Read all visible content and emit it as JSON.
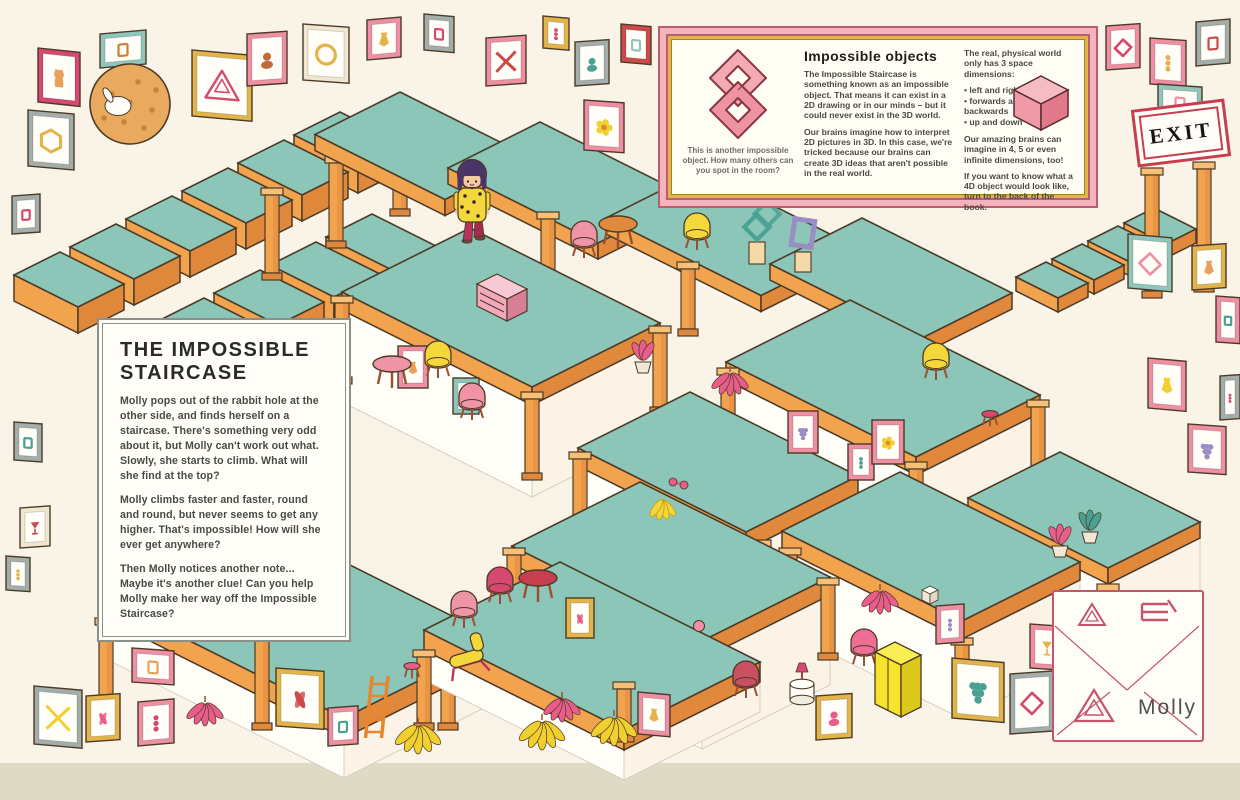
{
  "story_box": {
    "title": "THE IMPOSSIBLE STAIRCASE",
    "paragraphs": [
      "Molly pops out of the rabbit hole at the other side, and finds herself on a staircase. There's something very odd about it, but Molly can't work out what. Slowly, she starts to climb. What will she find at the top?",
      "Molly climbs faster and faster, round and round, but never seems to get any higher. That's impossible! How will she ever get anywhere?",
      "Then Molly notices another note... Maybe it's another clue! Can you help Molly make her way off the Impossible Staircase?"
    ]
  },
  "info_box": {
    "heading": "Impossible objects",
    "caption": "This is another impossible object. How many others can you spot in the room?",
    "col1_paragraphs": [
      "The Impossible Staircase is something known as an impossible object. That means it can exist in a 2D drawing or in our minds – but it could never exist in the 3D world.",
      "Our brains imagine how to interpret 2D pictures in 3D. In this case, we're tricked because our brains can create 3D ideas that aren't possible in the real world."
    ],
    "col2_intro": "The real, physical world only has 3 space dimensions:",
    "col2_bullets": [
      "left and right",
      "forwards and backwards",
      "up and down"
    ],
    "col2_paragraphs": [
      "Our amazing brains can imagine in 4, 5 or even infinite dimensions, too!",
      "If you want to know what a 4D object would look like, turn to the back of the book."
    ]
  },
  "exit_sign": {
    "label": "EXIT"
  },
  "envelope": {
    "label": "Molly"
  },
  "colors": {
    "line": "#4c3a26",
    "teal": "#8bc6b8",
    "orange": "#f2a34e",
    "orangeL": "#f7c078",
    "orangeD": "#e0893c",
    "wall": "#fffef8",
    "wall2": "#faf3e6",
    "wallEdge": "#d8cdbb",
    "bg": "#f9f3e8",
    "strip": "#dedac6",
    "accent_pink": "#ee8fa4",
    "accent_red": "#c73f4f"
  },
  "scene": {
    "structure": [
      {
        "op": "steps",
        "t": [
          60,
          252
        ],
        "n": 6,
        "dx": 56,
        "dy": -28,
        "a": 64,
        "b": 46,
        "h": 26
      },
      {
        "op": "steps",
        "t": [
          148,
          326
        ],
        "n": 5,
        "dx": 56,
        "dy": -28,
        "a": 64,
        "b": 46,
        "h": 26
      },
      {
        "op": "col",
        "p": [
          272,
          188,
          92
        ]
      },
      {
        "op": "col",
        "p": [
          336,
          156,
          92
        ]
      },
      {
        "op": "col",
        "p": [
          400,
          124,
          92
        ]
      },
      {
        "op": "plat",
        "t": [
          400,
          92
        ],
        "a": 130,
        "b": 85,
        "h": 16
      },
      {
        "op": "plat",
        "t": [
          540,
          122
        ],
        "a": 150,
        "b": 92,
        "h": 16
      },
      {
        "op": "plat",
        "t": [
          702,
          170
        ],
        "a": 155,
        "b": 96,
        "h": 16
      },
      {
        "op": "plat",
        "t": [
          862,
          218
        ],
        "a": 150,
        "b": 92,
        "h": 16
      },
      {
        "op": "col",
        "p": [
          548,
          212,
          74
        ]
      },
      {
        "op": "col",
        "p": [
          688,
          262,
          74
        ]
      },
      {
        "op": "col",
        "p": [
          858,
          312,
          74
        ]
      },
      {
        "op": "steps",
        "t": [
          1046,
          262
        ],
        "n": 4,
        "dx": 36,
        "dy": -18,
        "a": 42,
        "b": 30,
        "h": 14
      },
      {
        "op": "col",
        "p": [
          1152,
          168,
          130
        ]
      },
      {
        "op": "col",
        "p": [
          1204,
          162,
          130
        ]
      },
      {
        "op": "plat",
        "t": [
          470,
          228
        ],
        "a": 190,
        "b": 128,
        "h": 18,
        "s": 92
      },
      {
        "op": "col",
        "p": [
          342,
          296,
          88
        ]
      },
      {
        "op": "col",
        "p": [
          532,
          392,
          88
        ]
      },
      {
        "op": "col",
        "p": [
          660,
          326,
          88
        ]
      },
      {
        "op": "plat",
        "t": [
          850,
          300
        ],
        "a": 190,
        "b": 124,
        "h": 18,
        "s": 90
      },
      {
        "op": "col",
        "p": [
          728,
          368,
          86
        ]
      },
      {
        "op": "col",
        "p": [
          916,
          462,
          86
        ]
      },
      {
        "op": "col",
        "p": [
          1038,
          400,
          80
        ]
      },
      {
        "op": "plat",
        "t": [
          690,
          392
        ],
        "a": 168,
        "b": 112,
        "h": 18,
        "s": 88
      },
      {
        "op": "col",
        "p": [
          580,
          452,
          84
        ]
      },
      {
        "op": "col",
        "p": [
          760,
          540,
          84
        ]
      },
      {
        "op": "plat",
        "t": [
          1060,
          452
        ],
        "a": 140,
        "b": 92,
        "h": 16,
        "s": 60
      },
      {
        "op": "plat",
        "t": [
          900,
          472
        ],
        "a": 180,
        "b": 118,
        "h": 18,
        "s": 80
      },
      {
        "op": "col",
        "p": [
          790,
          548,
          100
        ]
      },
      {
        "op": "col",
        "p": [
          962,
          638,
          70
        ]
      },
      {
        "op": "col",
        "p": [
          1108,
          584,
          92
        ]
      },
      {
        "op": "plat",
        "t": [
          640,
          482
        ],
        "a": 190,
        "b": 128,
        "h": 18,
        "s": 90
      },
      {
        "op": "col",
        "p": [
          514,
          548,
          86
        ]
      },
      {
        "op": "col",
        "p": [
          700,
          644,
          78
        ]
      },
      {
        "op": "col",
        "p": [
          828,
          578,
          82
        ]
      },
      {
        "op": "plat",
        "t": [
          260,
          520
        ],
        "a": 240,
        "b": 156,
        "h": 20,
        "s": 40
      },
      {
        "op": "col",
        "p": [
          106,
          618,
          96
        ]
      },
      {
        "op": "col",
        "p": [
          262,
          620,
          110
        ]
      },
      {
        "op": "col",
        "p": [
          448,
          640,
          90
        ]
      },
      {
        "op": "plat",
        "t": [
          560,
          562
        ],
        "a": 200,
        "b": 136,
        "h": 20,
        "s": 30
      },
      {
        "op": "col",
        "p": [
          424,
          650,
          80
        ]
      },
      {
        "op": "col",
        "p": [
          624,
          682,
          60
        ]
      }
    ],
    "frames": [
      [
        38,
        48,
        42,
        54,
        "#d6486f",
        "cat",
        "#e8a05a",
        6
      ],
      [
        100,
        34,
        46,
        34,
        "#8fc5bb",
        "shape",
        "#c98138",
        -5
      ],
      [
        192,
        50,
        60,
        66,
        "#e2b44a",
        "tri",
        "#d6486f",
        5
      ],
      [
        247,
        34,
        40,
        52,
        "#ee8fa4",
        "portrait",
        "#c06a3a",
        -4
      ],
      [
        303,
        24,
        46,
        56,
        "#f1e6cf",
        "ring",
        "#e2b44a",
        4
      ],
      [
        367,
        20,
        34,
        40,
        "#ee8fa4",
        "vase",
        "#e2b44a",
        -5
      ],
      [
        424,
        14,
        30,
        36,
        "#a3adaa",
        "shape",
        "#d6486f",
        5
      ],
      [
        486,
        38,
        40,
        48,
        "#ee8fa4",
        "x",
        "#cc4a4a",
        -4
      ],
      [
        543,
        16,
        26,
        32,
        "#e2b44a",
        "dots",
        "#d6486f",
        5
      ],
      [
        575,
        42,
        34,
        44,
        "#a3adaa",
        "portrait",
        "#4aa193",
        -4
      ],
      [
        584,
        100,
        40,
        50,
        "#ee8fa4",
        "flower",
        "#f0cf2e",
        4
      ],
      [
        621,
        24,
        30,
        38,
        "#cc4a4a",
        "shape",
        "#8fc5bb",
        5
      ],
      [
        1106,
        26,
        34,
        44,
        "#ee8fa4",
        "diamond",
        "#d6486f",
        -4
      ],
      [
        1150,
        38,
        36,
        46,
        "#ee8fa4",
        "dots",
        "#e2b44a",
        4
      ],
      [
        1196,
        22,
        34,
        44,
        "#a3adaa",
        "shape",
        "#cc4a4a",
        -5
      ],
      [
        1158,
        84,
        44,
        34,
        "#8fc5bb",
        "shape",
        "#ee8fa4",
        4
      ],
      [
        1128,
        234,
        44,
        54,
        "#8fc5bb",
        "diamond",
        "#ee8fa4",
        5
      ],
      [
        1192,
        246,
        34,
        44,
        "#e2b44a",
        "vase",
        "#e8a05a",
        -4
      ],
      [
        1216,
        296,
        24,
        46,
        "#ee8fa4",
        "shape",
        "#4aa193",
        4
      ],
      [
        1148,
        358,
        38,
        50,
        "#ee8fa4",
        "vase",
        "#f0cf2e",
        5
      ],
      [
        1220,
        376,
        20,
        44,
        "#a3adaa",
        "dots",
        "#d6486f",
        -4
      ],
      [
        1188,
        424,
        38,
        48,
        "#ee8fa4",
        "grapes",
        "#9a8cc4",
        4
      ],
      [
        28,
        110,
        46,
        56,
        "#a3adaa",
        "hex",
        "#e2b44a",
        5
      ],
      [
        12,
        196,
        28,
        38,
        "#a3adaa",
        "shape",
        "#d6486f",
        -4
      ],
      [
        14,
        422,
        28,
        38,
        "#a3adaa",
        "shape",
        "#4aa193",
        4
      ],
      [
        20,
        508,
        30,
        40,
        "#f1e6cf",
        "goblet",
        "#cc4a4a",
        -4
      ],
      [
        6,
        556,
        24,
        34,
        "#a3adaa",
        "dots",
        "#e2b44a",
        4
      ],
      [
        34,
        686,
        48,
        58,
        "#a3adaa",
        "x",
        "#f0cf2e",
        5
      ],
      [
        86,
        696,
        34,
        46,
        "#e2b44a",
        "leaf",
        "#e85d8a",
        -4
      ],
      [
        132,
        648,
        42,
        34,
        "#ee8fa4",
        "shape",
        "#e8a05a",
        4
      ],
      [
        138,
        702,
        36,
        44,
        "#ee8fa4",
        "dots",
        "#d6486f",
        -5
      ],
      [
        276,
        668,
        48,
        58,
        "#e2b44a",
        "leaf",
        "#cc4a4a",
        4
      ],
      [
        328,
        708,
        30,
        38,
        "#ee8fa4",
        "shape",
        "#4aa193",
        -4
      ],
      [
        638,
        692,
        32,
        42,
        "#ee8fa4",
        "vase",
        "#e2b44a",
        5
      ],
      [
        816,
        696,
        36,
        44,
        "#e2b44a",
        "portrait",
        "#e85d8a",
        -4
      ],
      [
        952,
        658,
        52,
        60,
        "#e2b44a",
        "grapes",
        "#4aa193",
        5
      ],
      [
        1010,
        674,
        44,
        60,
        "#a3adaa",
        "diamond",
        "#d6486f",
        -4
      ],
      [
        1030,
        624,
        34,
        44,
        "#ee8fa4",
        "goblet",
        "#e2b44a",
        4
      ],
      [
        936,
        606,
        28,
        38,
        "#ee8fa4",
        "dots",
        "#9a8cc4",
        -4
      ],
      [
        398,
        346,
        30,
        42,
        "#ee8fa4",
        "vase",
        "#e8a05a",
        0
      ],
      [
        453,
        378,
        26,
        36,
        "#8fc5bb",
        "shape",
        "#d6486f",
        0
      ],
      [
        788,
        411,
        30,
        42,
        "#ee8fa4",
        "grapes",
        "#9a8cc4",
        0
      ],
      [
        848,
        444,
        26,
        36,
        "#ee8fa4",
        "dots",
        "#4aa193",
        0
      ],
      [
        566,
        598,
        28,
        40,
        "#e2b44a",
        "leaf",
        "#e85d8a",
        0
      ],
      [
        872,
        420,
        32,
        44,
        "#ee8fa4",
        "flower",
        "#f0cf2e",
        0
      ]
    ],
    "furniture": [
      [
        "table-round",
        618,
        224,
        "#e08a3e"
      ],
      [
        "chair",
        697,
        230,
        "#f3d73b"
      ],
      [
        "chair",
        584,
        238,
        "#ef93a6"
      ],
      [
        "sculpt-chain",
        757,
        232,
        "#4aa193"
      ],
      [
        "sculpt-frame",
        803,
        244,
        "#9a8cc4"
      ],
      [
        "drawers",
        497,
        288,
        "#f2a9bb"
      ],
      [
        "table-round",
        392,
        364,
        "#ef93a6"
      ],
      [
        "chair",
        438,
        358,
        "#f3d73b"
      ],
      [
        "chair",
        472,
        400,
        "#ef93a6"
      ],
      [
        "plant-pot",
        643,
        364,
        "#e85d8a"
      ],
      [
        "plant-hang",
        730,
        372,
        "#e85d8a"
      ],
      [
        "chair",
        936,
        360,
        "#f3d73b"
      ],
      [
        "stool",
        990,
        414,
        "#d6486f"
      ],
      [
        "bananas",
        662,
        500,
        "#f3d73b"
      ],
      [
        "toy",
        678,
        482,
        "#e85d8a"
      ],
      [
        "table-round",
        538,
        578,
        "#c73f4f"
      ],
      [
        "chair",
        500,
        584,
        "#d6486f"
      ],
      [
        "chair",
        464,
        608,
        "#ef93a6"
      ],
      [
        "lounge",
        468,
        660,
        "#f3d73b"
      ],
      [
        "stool",
        412,
        666,
        "#e85d8a"
      ],
      [
        "chair",
        746,
        678,
        "#c94f62"
      ],
      [
        "side-table",
        802,
        694,
        "#fffef8"
      ],
      [
        "chair",
        864,
        646,
        "#ef6e96"
      ],
      [
        "wardrobe",
        895,
        674,
        "#f6e32a"
      ],
      [
        "dice",
        930,
        592,
        "#efe8da"
      ],
      [
        "ball",
        699,
        626,
        "#ef93a6"
      ],
      [
        "plant-hang",
        205,
        702,
        "#e85d8a"
      ],
      [
        "plant-hang",
        562,
        698,
        "#e85d8a"
      ],
      [
        "monstera",
        542,
        720,
        "#f0cf2e"
      ],
      [
        "monstera",
        614,
        716,
        "#f0cf2e"
      ],
      [
        "monstera",
        418,
        724,
        "#f0cf2e"
      ],
      [
        "plant-pot",
        1090,
        534,
        "#4aa193"
      ],
      [
        "plant-pot",
        1060,
        548,
        "#e85d8a"
      ],
      [
        "ladder",
        372,
        676,
        "#e8862e"
      ],
      [
        "cookie",
        130,
        104,
        "#e9aa60"
      ],
      [
        "plant-hang",
        880,
        590,
        "#e85d8a"
      ]
    ],
    "molly": [
      472,
      240
    ]
  }
}
